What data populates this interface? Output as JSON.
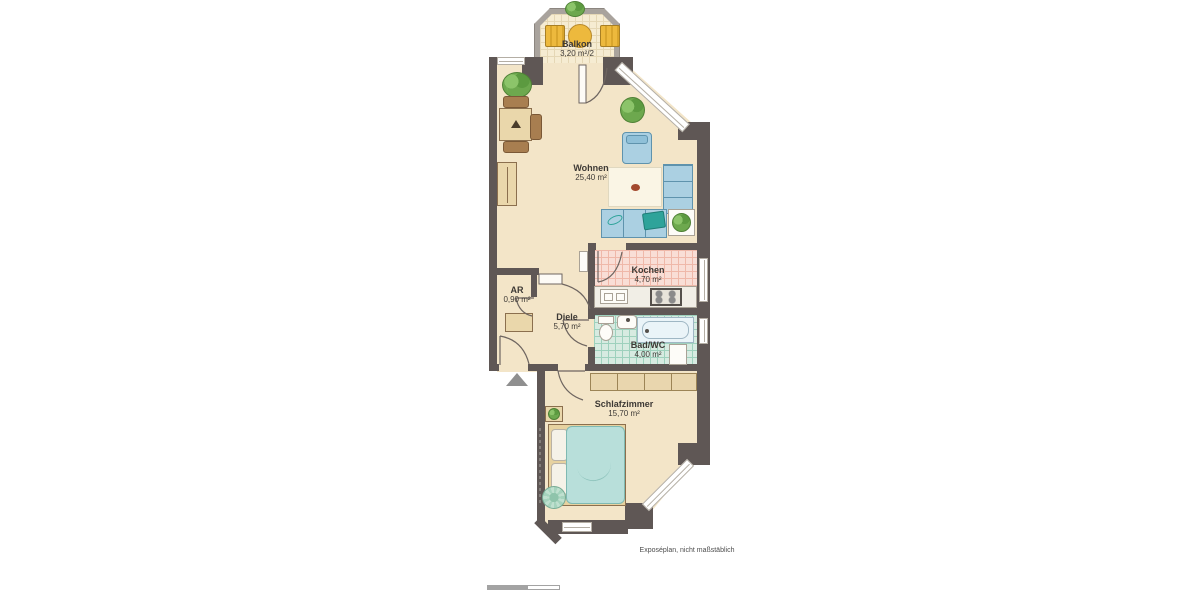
{
  "rooms": [
    {
      "id": "balkon",
      "name": "Balkon",
      "area": "3,20 m²/2"
    },
    {
      "id": "wohnen",
      "name": "Wohnen",
      "area": "25,40 m²"
    },
    {
      "id": "kochen",
      "name": "Kochen",
      "area": "4,70 m²"
    },
    {
      "id": "ar",
      "name": "AR",
      "area": "0,90 m²"
    },
    {
      "id": "diele",
      "name": "Diele",
      "area": "5,70 m²"
    },
    {
      "id": "bad",
      "name": "Bad/WC",
      "area": "4,00 m²"
    },
    {
      "id": "schlafzimmer",
      "name": "Schlafzimmer",
      "area": "15,70 m²"
    }
  ],
  "footnote": "Exposéplan, nicht maßstäblich",
  "colors": {
    "wall": "#5f5755",
    "floor": "#f3e5c8",
    "kitchen_floor": "#f9ded6",
    "bath_floor": "#d7ebe1",
    "balcony_wall": "#a9a39d",
    "sofa_blue": "#abd0e2",
    "bed_teal": "#b8dfda",
    "balcony_furniture_yellow": "#edb93d",
    "plant_green": "#6da84e",
    "rug_dot_red": "#a34a2e"
  }
}
